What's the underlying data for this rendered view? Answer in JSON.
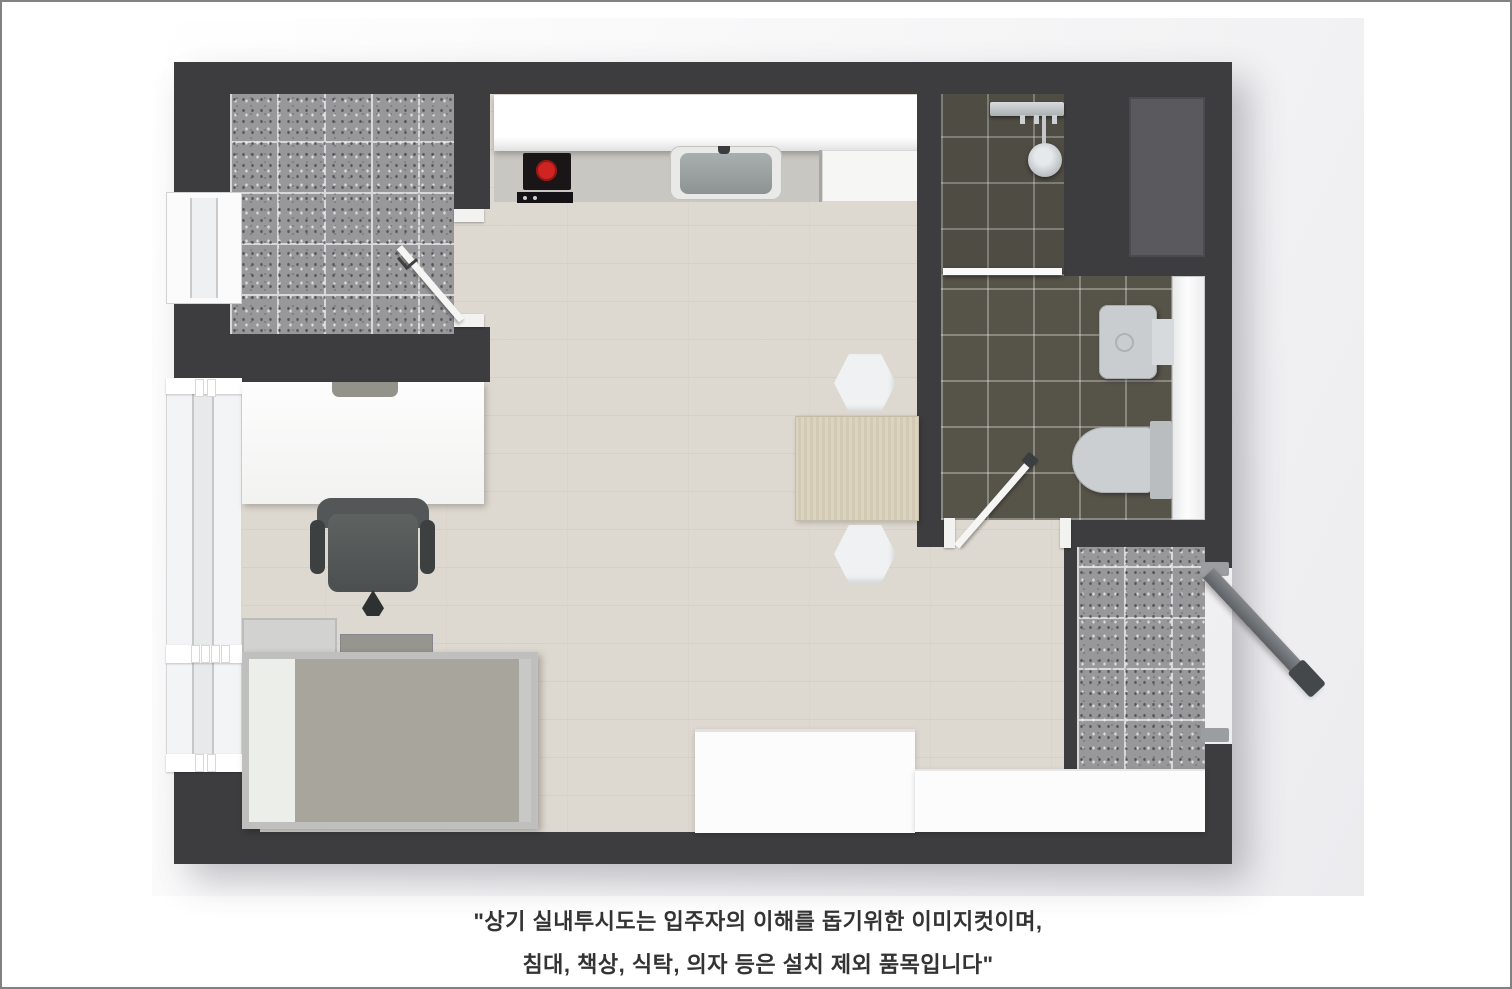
{
  "image": {
    "type": "3d-floor-plan-top-view",
    "caption": {
      "line1": "\"상기 실내투시도는 입주자의 이해를 돕기위한 이미지컷이며,",
      "line2": "침대, 책상, 식탁, 의자 등은 설치 제외 품목입니다\""
    },
    "colors": {
      "wall": "#3d3d3f",
      "wood_floor": "#ddd8d0",
      "entry_tile": "#98989a",
      "bathroom_tile": "#565349",
      "balcony_tile": "#98989a",
      "kitchen_counter": "#c9c7c2",
      "burner_accent": "#d02422",
      "furniture_white": "#fcfcfc",
      "table_wood": "#d8d1bc",
      "bed_blanket": "#a8a69c",
      "chair": "#545858",
      "caption_text": "#333333",
      "page_border": "#828282"
    },
    "elements": [
      "entry-vestibule",
      "entry-door",
      "kitchen-upper-cabinet",
      "kitchen-counter",
      "cooktop",
      "kitchen-sink",
      "kitchen-appliance",
      "bathroom",
      "shower-set",
      "shower-partition",
      "washbasin",
      "toilet",
      "bathroom-door",
      "utility-box",
      "balcony",
      "entrance-door",
      "window",
      "desk",
      "office-chair",
      "single-bed",
      "headboard-shelves",
      "dining-table",
      "stool",
      "storage-unit-a",
      "storage-unit-b"
    ]
  }
}
